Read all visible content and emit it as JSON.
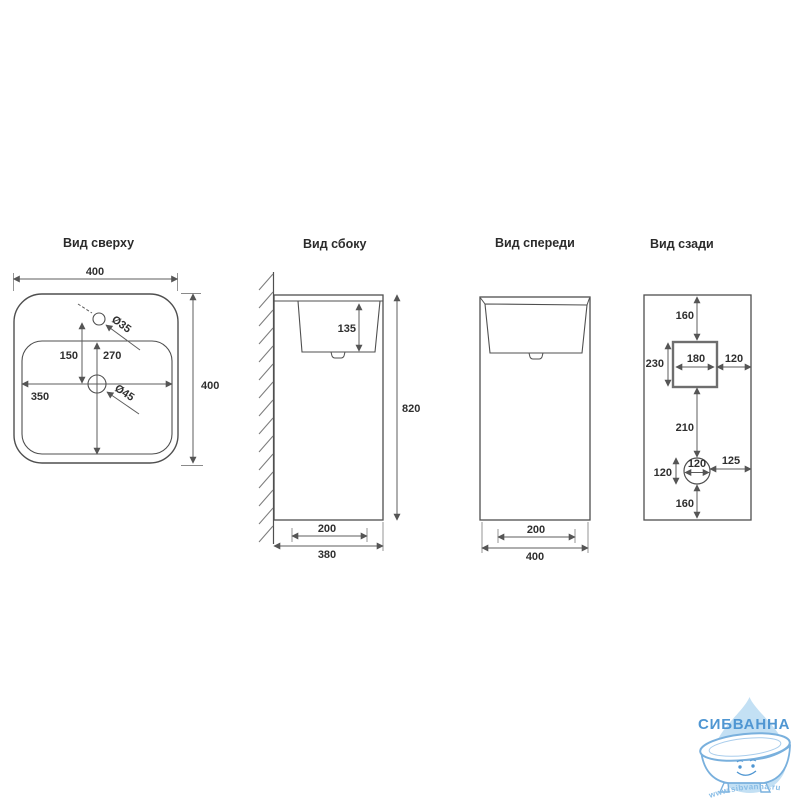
{
  "top_view": {
    "title": "Вид сверху",
    "dim_width": "400",
    "dim_height": "400",
    "dim_basin_width": "350",
    "dim_basin_length": "270",
    "dim_faucet_offset": "150",
    "dim_faucet_hole": "Ø35",
    "dim_drain_hole": "Ø45"
  },
  "side_view": {
    "title": "Вид сбоку",
    "dim_basin_depth": "135",
    "dim_height": "820",
    "dim_base_depth": "200",
    "dim_total_depth": "380"
  },
  "front_view": {
    "title": "Вид спереди",
    "dim_base_width": "200",
    "dim_total_width": "400"
  },
  "back_view": {
    "title": "Вид сзади",
    "dim_top_offset": "160",
    "dim_niche_width": "180",
    "dim_niche_height": "230",
    "dim_niche_right": "120",
    "dim_niche_to_hole": "210",
    "dim_hole_diameter": "120",
    "dim_hole_height": "120",
    "dim_hole_right": "125",
    "dim_bottom_offset": "160"
  },
  "logo": {
    "brand": "СИБВАННА",
    "website": "www.sibvanna.ru",
    "colors": {
      "brand_blue": "#4f96d2",
      "drop_fill": "#c3e0f4",
      "tub_outline": "#79b0dd"
    }
  },
  "drawing": {
    "line_color": "#4f4f4f",
    "dimension_color": "#5c5c5c",
    "background": "#ffffff"
  }
}
